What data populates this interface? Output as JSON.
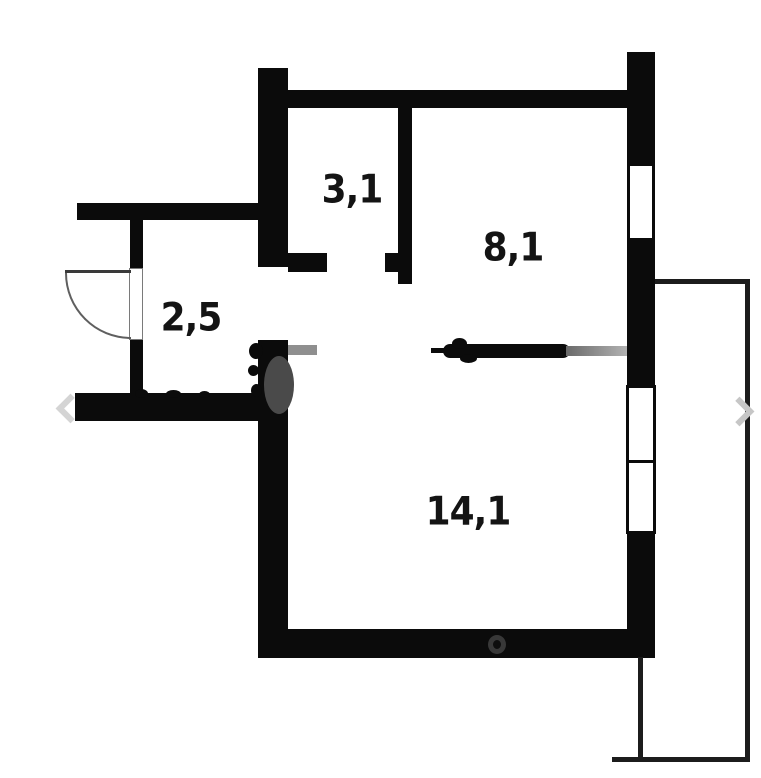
{
  "floorplan": {
    "type": "apartment-floor-plan",
    "rooms": [
      {
        "name": "wc",
        "area": "3,1"
      },
      {
        "name": "kitchen",
        "area": "8,1"
      },
      {
        "name": "hallway",
        "area": "2,5"
      },
      {
        "name": "living-room",
        "area": "14,1"
      }
    ],
    "features": {
      "entry_door": "swing-door-arc-left-wall",
      "kitchen_window": "right-wall-single-pane",
      "living_room_window": "right-wall-double-pane",
      "balcony": "right-side-outline"
    },
    "icons": {
      "prev_arrow": "chevron-left-icon",
      "next_arrow": "chevron-right-icon"
    },
    "colors": {
      "wall": "#0b0b0b",
      "background": "#ffffff",
      "watermark_gray": "#8f8f8f",
      "balcony_line": "#1c1c1c"
    }
  }
}
